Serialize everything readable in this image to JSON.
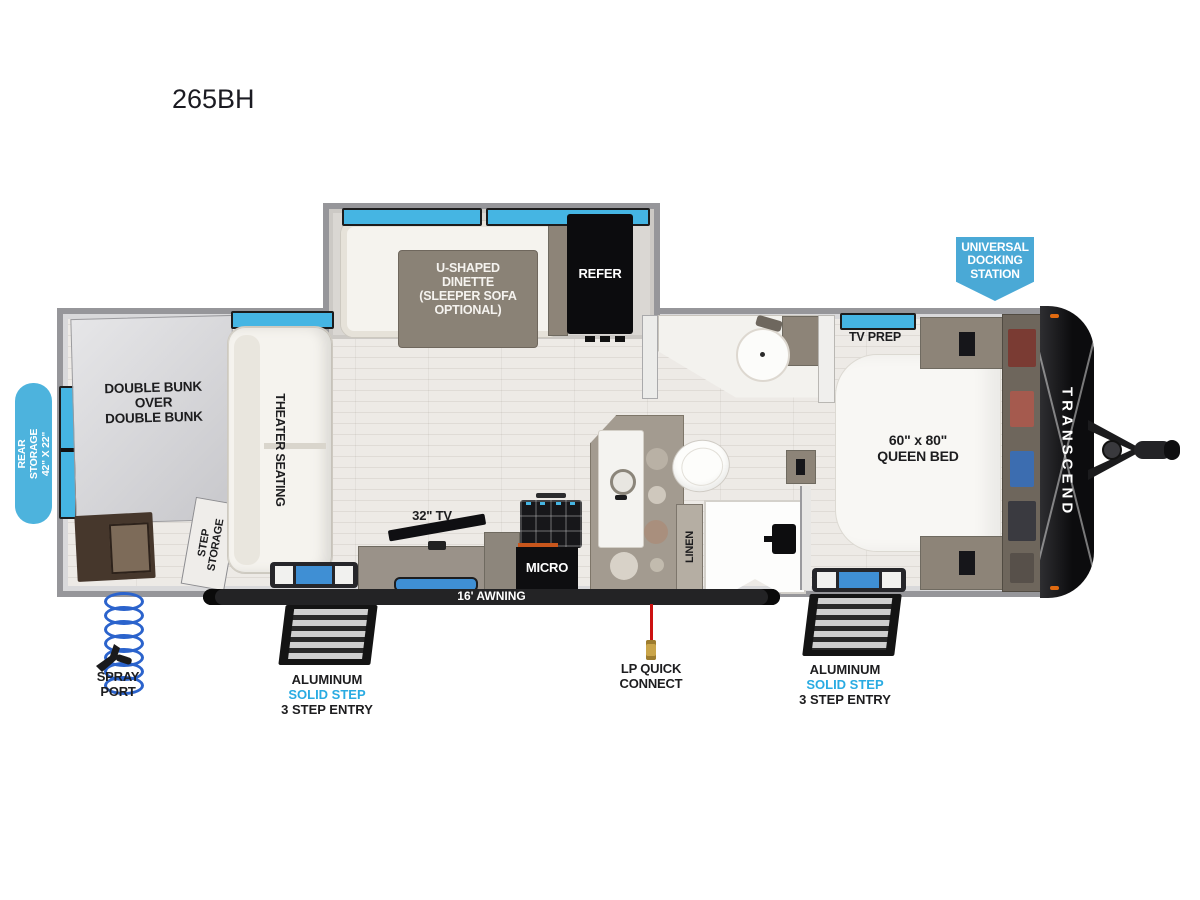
{
  "title": "265BH",
  "brand": "TRANSCEND",
  "callouts": {
    "docking": [
      "UNIVERSAL",
      "DOCKING",
      "STATION"
    ],
    "rear_storage": [
      "REAR STORAGE",
      "42\" X 22\""
    ]
  },
  "slideout": {
    "dinette": [
      "U-SHAPED",
      "DINETTE",
      "(SLEEPER SOFA",
      "OPTIONAL)"
    ],
    "refer": "REFER"
  },
  "rooms": {
    "bunk": [
      "DOUBLE BUNK",
      "OVER",
      "DOUBLE BUNK"
    ],
    "step_storage": [
      "STEP",
      "STORAGE"
    ],
    "theater": "THEATER SEATING",
    "tv": "32\" TV",
    "micro": "MICRO",
    "linen": "LINEN",
    "tv_prep": "TV PREP",
    "bed": [
      "60\" x 80\"",
      "QUEEN BED"
    ]
  },
  "bottom": {
    "awning": "16' AWNING",
    "spray_port": [
      "SPRAY",
      "PORT"
    ],
    "lp": [
      "LP QUICK",
      "CONNECT"
    ],
    "left_step": [
      "ALUMINUM",
      "SOLID STEP",
      "3 STEP ENTRY"
    ],
    "right_step": [
      "ALUMINUM",
      "SOLID STEP",
      "3 STEP ENTRY"
    ]
  },
  "colors": {
    "window_blue": "#45b5e3",
    "callout_blue": "#4aa9d6",
    "step_label_blue": "#29abe2",
    "coil_blue": "#2b63cc",
    "lp_red": "#cc1111"
  }
}
